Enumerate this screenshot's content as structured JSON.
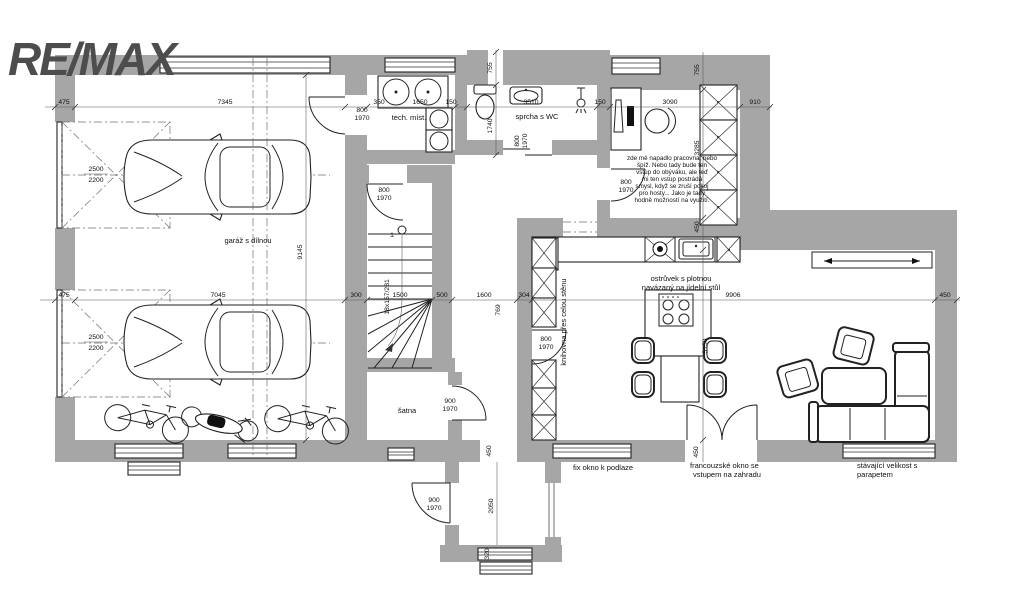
{
  "brand": {
    "logo": "RE/MAX"
  },
  "colors": {
    "wall": "#a6a6a6",
    "logo": "#4d4d4d",
    "line": "#222222"
  },
  "labels": {
    "garage": "garáž s dílnou",
    "tech_room": "tech. míst.",
    "bathroom": "sprcha s WC",
    "closet": "šatna",
    "island_line1": "ostrůvek s plotnou",
    "island_line2": "navázaný na jídelní stůl",
    "library": "knihovna přes celou stěnu",
    "fix_window": "fix okno k podlaze",
    "french_line1": "francouzské okno se",
    "french_line2": "vstupem na zahradu",
    "existing_line1": "stávající velikost s",
    "existing_line2": "parapetem",
    "note_line1": "zde mě napadlo pracovna, nebo",
    "note_line2": "špíž. Nebo tady bude ten",
    "note_line3": "vstup do obýváku, ale teď",
    "note_line4": "mi ten vstup postrádá",
    "note_line5": "smysl, když se zruší pokoj",
    "note_line6": "pro hosty... Jako je tady",
    "note_line7": "hodně možností na využití."
  },
  "dims": {
    "475": "475",
    "7345": "7345",
    "7045": "7045",
    "350": "350",
    "1650": "1650",
    "150": "150",
    "3510": "3510",
    "1740": "1740",
    "755": "755",
    "3090": "3090",
    "910": "910",
    "2500": "2500",
    "2200": "2200",
    "9145": "9145",
    "300": "300",
    "1500": "1500",
    "500": "500",
    "1600": "1600",
    "769": "769",
    "304": "304",
    "9906": "9906",
    "450": "450",
    "3285": "3285",
    "5150": "5150",
    "800": "800",
    "1970": "1970",
    "900": "900",
    "2050": "2050",
    "320": "320",
    "stairs18": "18x157/281",
    "step1": "1"
  }
}
